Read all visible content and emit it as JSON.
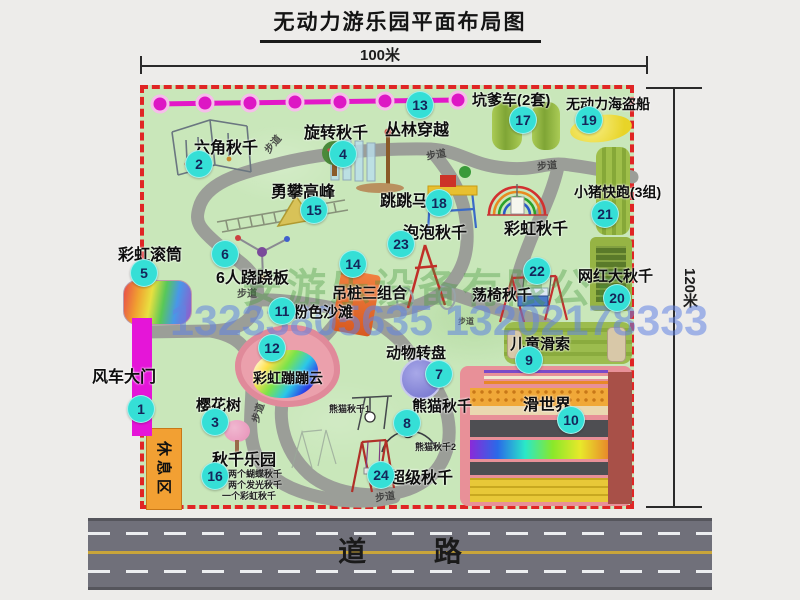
{
  "title": "无动力游乐园平面布局图",
  "dim_top": "100米",
  "dim_right": "120米",
  "road_label": "道 路",
  "path_label": "步道",
  "rest_area_label": "休息区",
  "extra_label_rainbow_swing": "彩虹秋千",
  "watermark": {
    "company": "安游乐设备有限公司",
    "phone": "13233805635 13202178333"
  },
  "panda_labels": [
    "熊猫秋千1",
    "熊猫秋千2"
  ],
  "attractions": [
    {
      "num": "1",
      "name": "风车大门"
    },
    {
      "num": "2",
      "name": "六角秋千"
    },
    {
      "num": "3",
      "name": "樱花树"
    },
    {
      "num": "4",
      "name": "旋转秋千"
    },
    {
      "num": "5",
      "name": "彩虹滚筒"
    },
    {
      "num": "6",
      "name": "6人跷跷板"
    },
    {
      "num": "7",
      "name": "动物转盘"
    },
    {
      "num": "8",
      "name": "熊猫秋千"
    },
    {
      "num": "9",
      "name": "儿童滑索"
    },
    {
      "num": "10",
      "name": "滑世界"
    },
    {
      "num": "11",
      "name": "粉色沙滩"
    },
    {
      "num": "12",
      "name": "彩虹蹦蹦云"
    },
    {
      "num": "13",
      "name": "丛林穿越"
    },
    {
      "num": "14",
      "name": "吊桩三组合"
    },
    {
      "num": "15",
      "name": "勇攀高峰"
    },
    {
      "num": "16",
      "name": "秋千乐园",
      "notes": [
        "两个蝴蝶秋千",
        "两个发光秋千",
        "一个彩虹秋千"
      ]
    },
    {
      "num": "17",
      "name": "坑爹车(2套)"
    },
    {
      "num": "18",
      "name": "跳跳马"
    },
    {
      "num": "19",
      "name": "无动力海盗船"
    },
    {
      "num": "20",
      "name": "网红大秋千"
    },
    {
      "num": "21",
      "name": "小猪快跑(3组)"
    },
    {
      "num": "22",
      "name": "荡椅秋千"
    },
    {
      "num": "23",
      "name": "泡泡秋千"
    },
    {
      "num": "24",
      "name": "超级秋千"
    }
  ],
  "colors": {
    "badge": "#35dfd6",
    "border": "#e02525",
    "grass": "#c9e7ba",
    "road": "#70707a",
    "zipline": "#e318c8",
    "entrance": "#e515d8",
    "rest": "#f2a033"
  }
}
